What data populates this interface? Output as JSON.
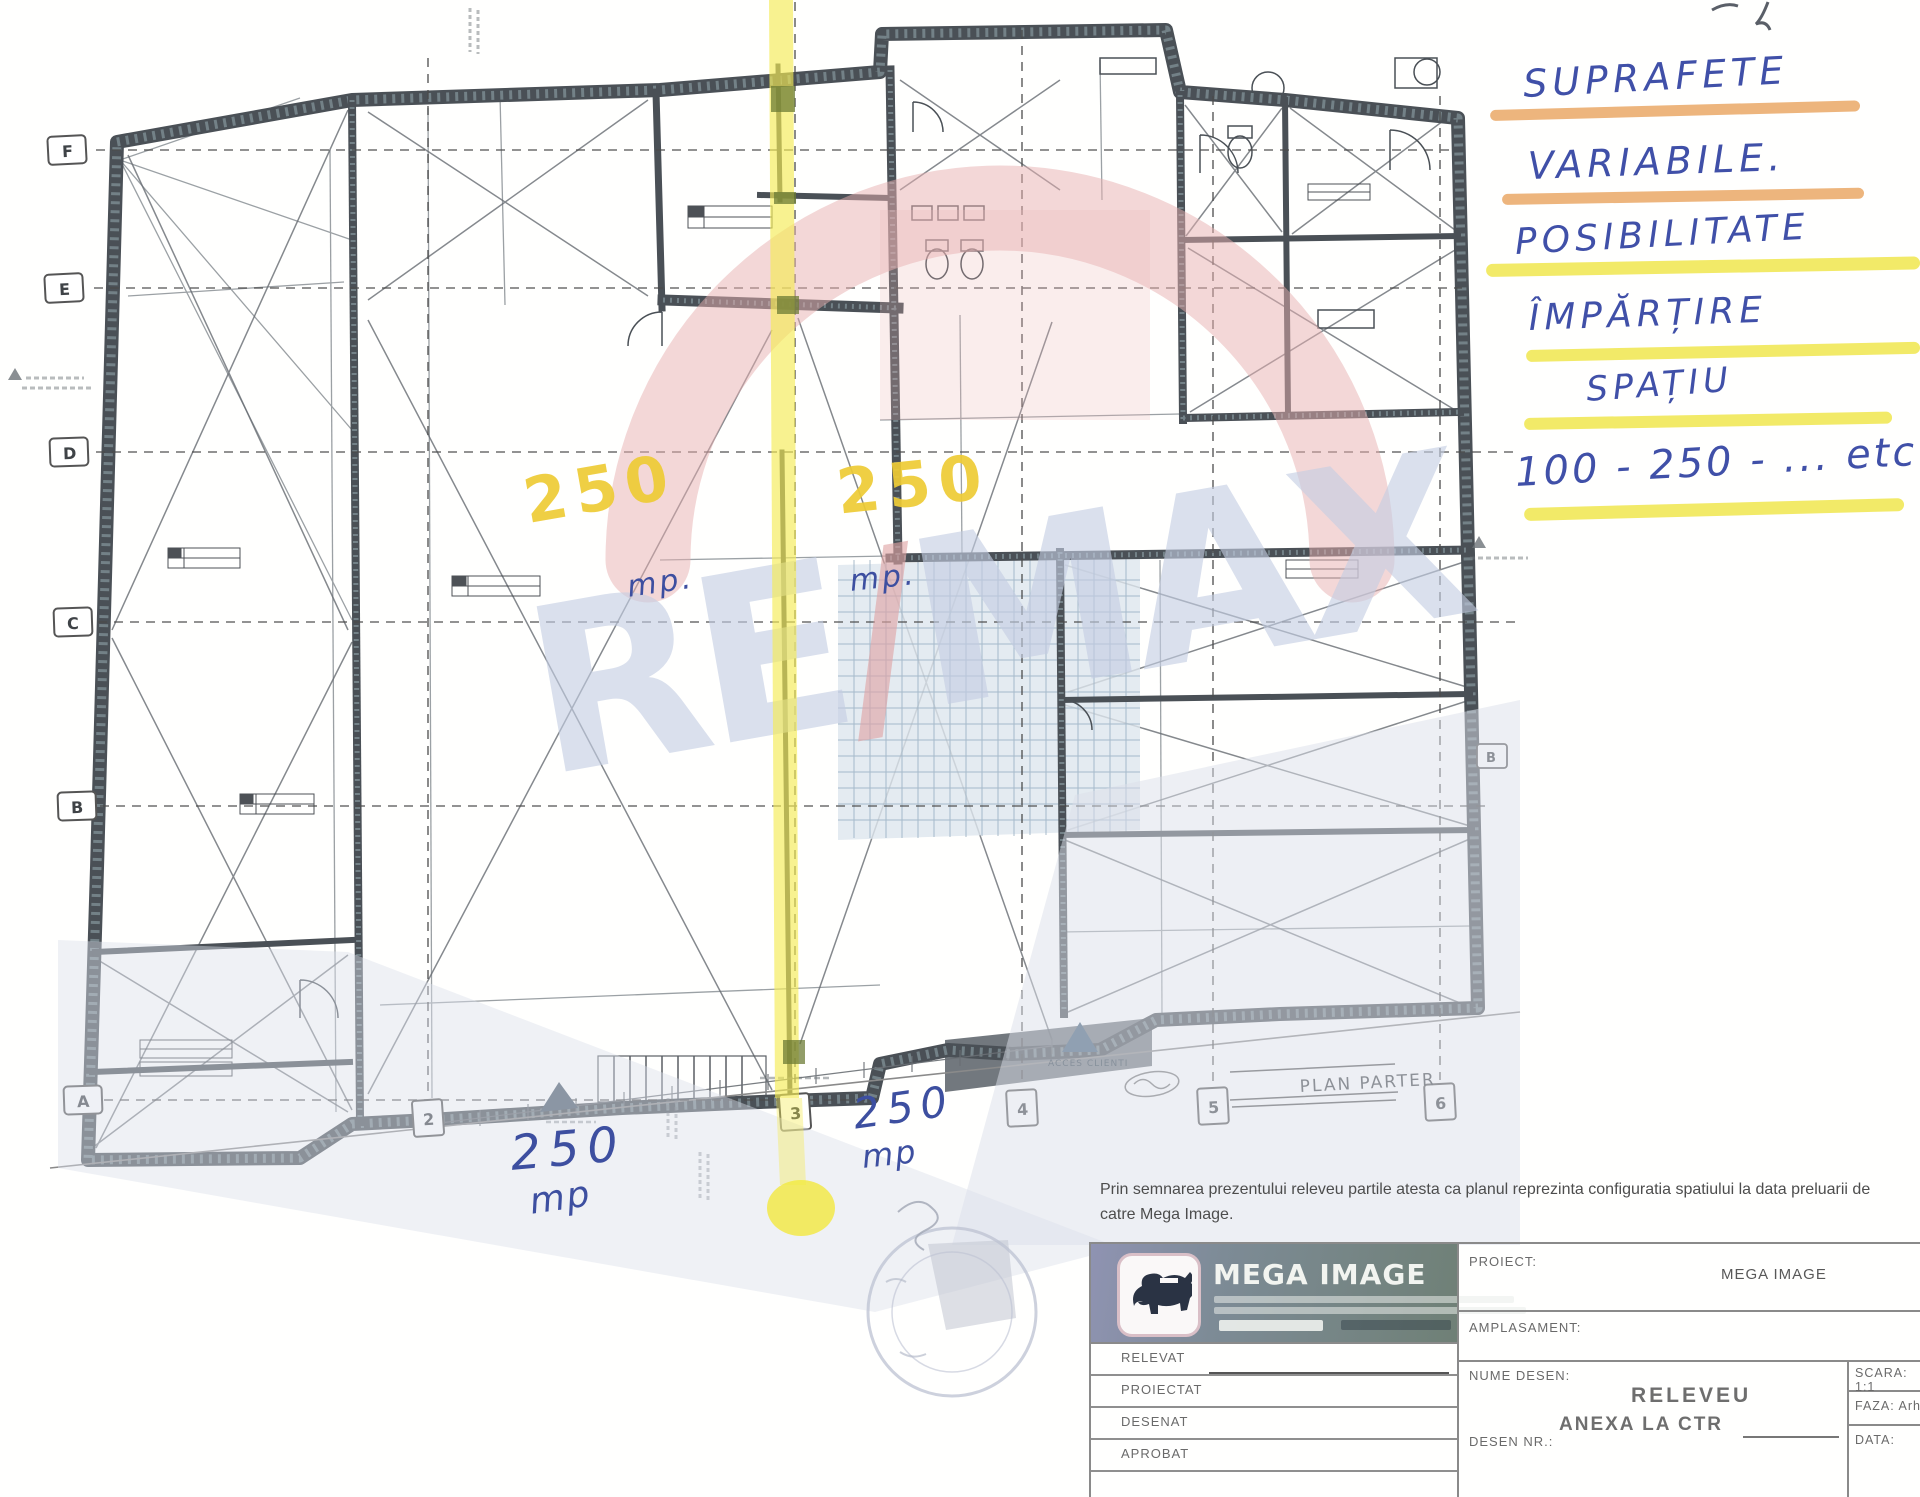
{
  "page": {
    "width": 1920,
    "height": 1497
  },
  "handwriting": {
    "ink_color": "#4050a8",
    "notes": [
      {
        "text": "SUPRAFETE",
        "underline": "orange"
      },
      {
        "text": "VARIABILE.",
        "underline": "orange"
      },
      {
        "text": "POSIBILITATE",
        "underline": "yellow"
      },
      {
        "text": "ÎMPĂRȚIRE",
        "underline": "yellow"
      },
      {
        "text": "SPAȚIU",
        "underline": "yellow"
      },
      {
        "text": "100 - 250 - ... etc",
        "underline": "yellow"
      }
    ],
    "underline_orange": "#e8a35c",
    "underline_yellow": "#f0e64e",
    "highlight_line_color": "#f4eb55",
    "area_number_color": "#eecb35",
    "areas_yellow": [
      {
        "value": "250",
        "unit": "mp."
      },
      {
        "value": "250",
        "unit": "mp."
      }
    ],
    "areas_blue": [
      {
        "value": "250",
        "unit": "mp"
      },
      {
        "value": "250",
        "unit": "mp"
      }
    ]
  },
  "plan": {
    "grid_rows": [
      "F",
      "E",
      "D",
      "C",
      "B",
      "A"
    ],
    "grid_cols": [
      "2",
      "3",
      "4",
      "5",
      "6"
    ],
    "side_row_label": "B",
    "drawing_title": "PLAN PARTER",
    "access_label": "ACCES CLIENTI"
  },
  "watermark": {
    "re": "RE",
    "slash": "/",
    "max": "MAX",
    "letter_color": "#c3cde2",
    "slash_color": "#dfa4a4",
    "balloon_color": "#e8b0b0"
  },
  "footer": {
    "disclaimer_line1": "Prin semnarea prezentului releveu partile atesta ca planul  reprezinta configuratia spatiului la data preluarii de",
    "disclaimer_line2": "catre Mega Image.",
    "titleblock": {
      "logo_title": "MEGA IMAGE",
      "sign_rows": [
        "RELEVAT",
        "PROIECTAT",
        "DESENAT",
        "APROBAT"
      ],
      "proiect_label": "PROIECT:",
      "proiect_value": "MEGA IMAGE",
      "amplasament_label": "AMPLASAMENT:",
      "nume_desen_label": "NUME DESEN:",
      "drawing_name_1": "RELEVEU",
      "drawing_name_2": "ANEXA LA CTR",
      "desen_nr_label": "DESEN NR.:",
      "scara_label": "SCARA: 1:1",
      "faza_label": "FAZA: Arh.",
      "data_label": "DATA:"
    }
  }
}
